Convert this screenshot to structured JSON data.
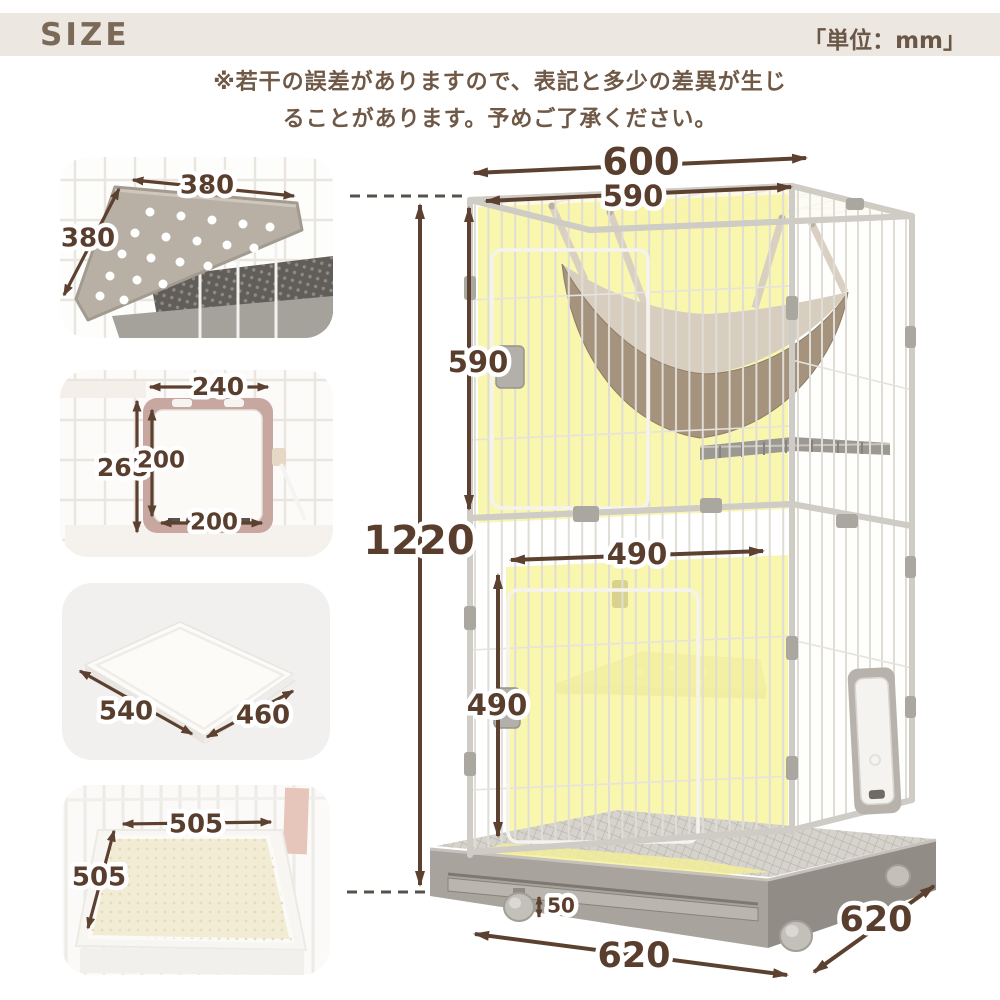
{
  "header": {
    "title": "SIZE",
    "unit_label": "「単位：mm」"
  },
  "note": {
    "line1": "※若干の誤差がありますので、表記と多少の差異が生じ",
    "line2": "ることがあります。予めご了承ください。"
  },
  "details": {
    "corner_shelf": {
      "width": "380",
      "depth": "380"
    },
    "cat_door": {
      "width": "240",
      "outer_height": "265",
      "inner_height": "200",
      "inner_width": "200"
    },
    "tray": {
      "width": "540",
      "depth": "460"
    },
    "mat": {
      "width": "505",
      "depth": "505"
    }
  },
  "cage": {
    "outer_width": "600",
    "inner_width": "590",
    "upper_height": "590",
    "total_height": "1220",
    "lower_inner_width": "490",
    "lower_height": "490",
    "caster_height": "50",
    "base_width": "620",
    "base_depth": "620"
  },
  "colors": {
    "accent_brown": "#5d4130",
    "highlight_yellow": "#f8f5a5",
    "header_bg": "#ece7e1",
    "hammock_tan": "#a5937d",
    "base_gray": "#a8a49d"
  }
}
